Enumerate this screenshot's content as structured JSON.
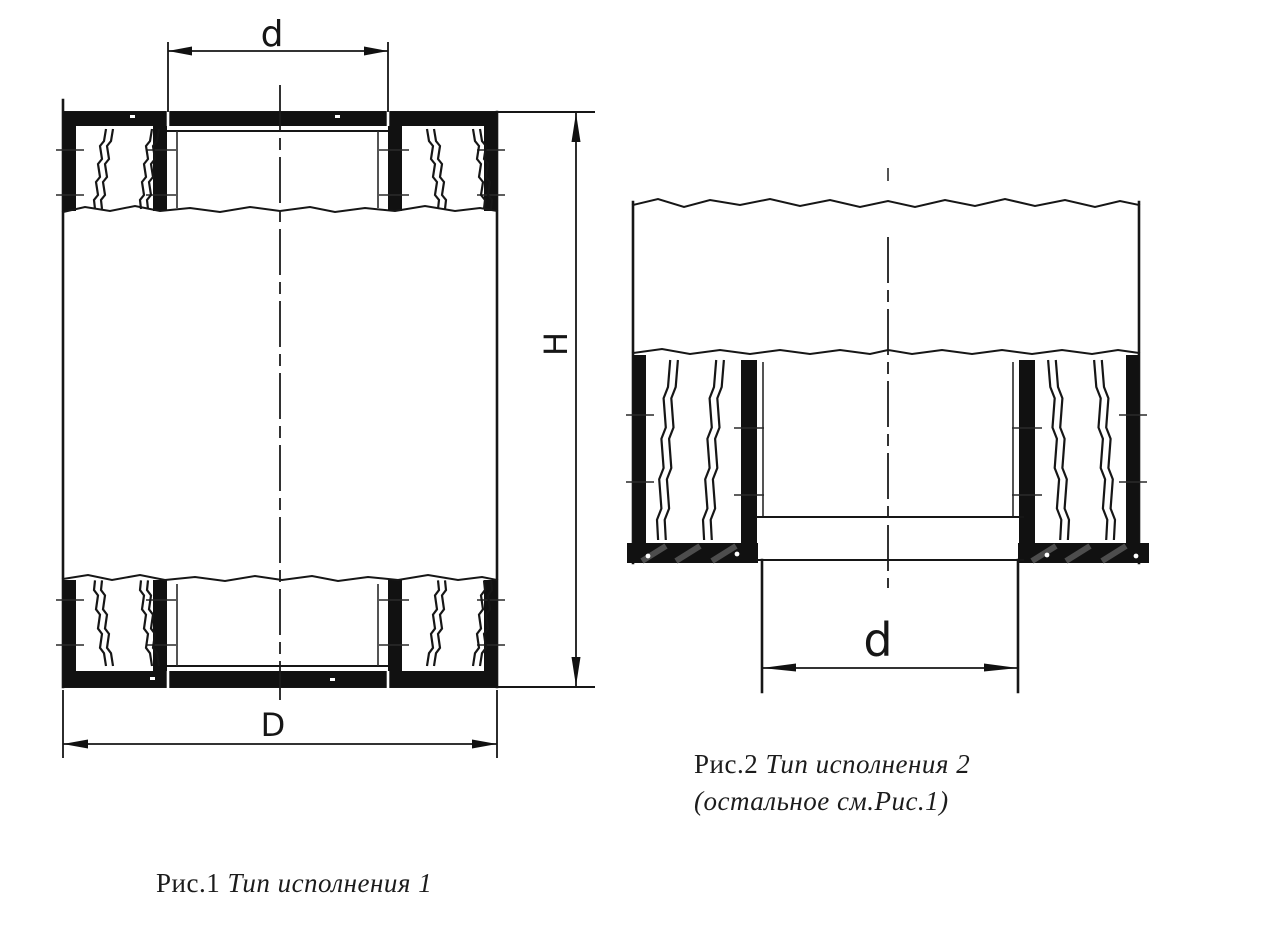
{
  "page": {
    "background": "#ffffff",
    "ink_color": "#161616"
  },
  "figure1": {
    "caption": {
      "prefix": "Рис.1",
      "title": "Тип исполнения 1"
    },
    "labels": {
      "inner_diameter": "d",
      "outer_diameter": "D",
      "height": "H"
    }
  },
  "figure2": {
    "caption": {
      "prefix": "Рис.2",
      "title": "Тип исполнения 2",
      "note": "(остальное см.Рис.1)"
    },
    "labels": {
      "spigot_diameter": "d"
    }
  }
}
